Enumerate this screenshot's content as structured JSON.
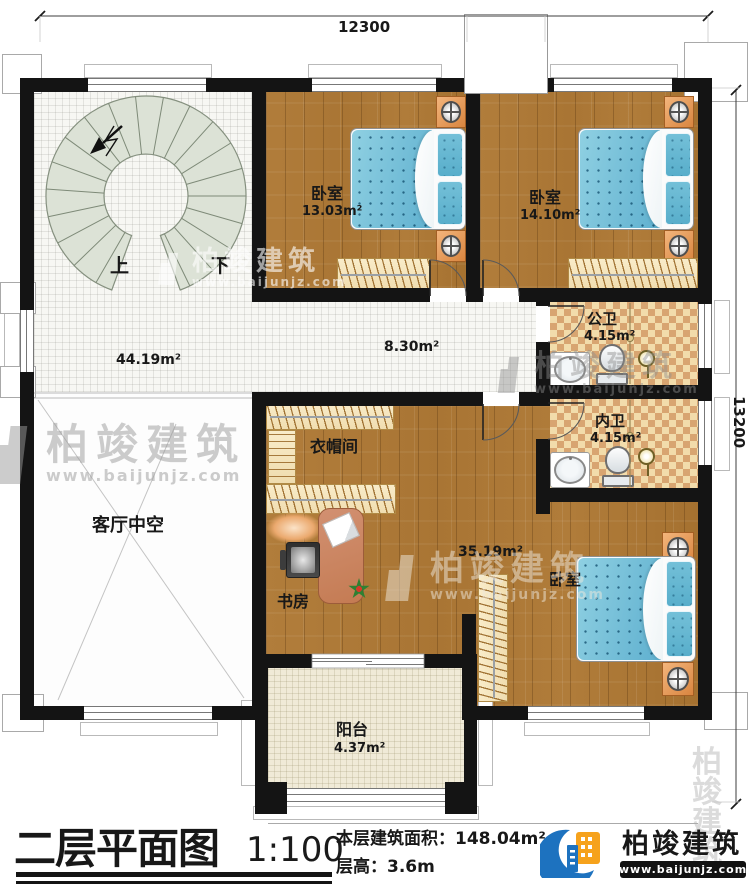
{
  "dimensions": {
    "top": "12300",
    "right": "13200"
  },
  "stairs": {
    "up": "上",
    "down": "下"
  },
  "rooms": {
    "bedroom1": {
      "name": "卧室",
      "area": "13.03m²"
    },
    "bedroom2": {
      "name": "卧室",
      "area": "14.10m²"
    },
    "public_bath": {
      "name": "公卫",
      "area": "4.15m²"
    },
    "inner_bath": {
      "name": "内卫",
      "area": "4.15m²"
    },
    "master_bedroom": {
      "name": "卧室",
      "area": "35.19m²"
    },
    "cloakroom": {
      "name": "衣帽间"
    },
    "study": {
      "name": "书房"
    },
    "living_void": {
      "name": "客厅中空"
    },
    "balcony": {
      "name": "阳台",
      "area": "4.37m²"
    },
    "hall": {
      "area": "44.19m²"
    },
    "corridor": {
      "area": "8.30m²"
    }
  },
  "title_block": {
    "title": "二层平面图",
    "scale": "1:100",
    "area_label": "本层建筑面积：",
    "area_value": "148.04m²",
    "height_label": "层高：",
    "height_value": "3.6m"
  },
  "brand": {
    "name": "柏竣建筑",
    "website": "www.baijunjz.com"
  },
  "watermark": {
    "name": "柏竣建筑",
    "website": "www.baijunjz.com"
  },
  "colors": {
    "wall": "#141414",
    "wood": "#ab7a36",
    "tile": "#f7f7f3",
    "bath_tile_light": "#f2dcab",
    "bath_tile_dark": "#d8a571",
    "bed": "#7fc6de",
    "nightstand": "#e0924f",
    "brand_blue": "#1d72bf",
    "brand_orange": "#f6a21c"
  }
}
